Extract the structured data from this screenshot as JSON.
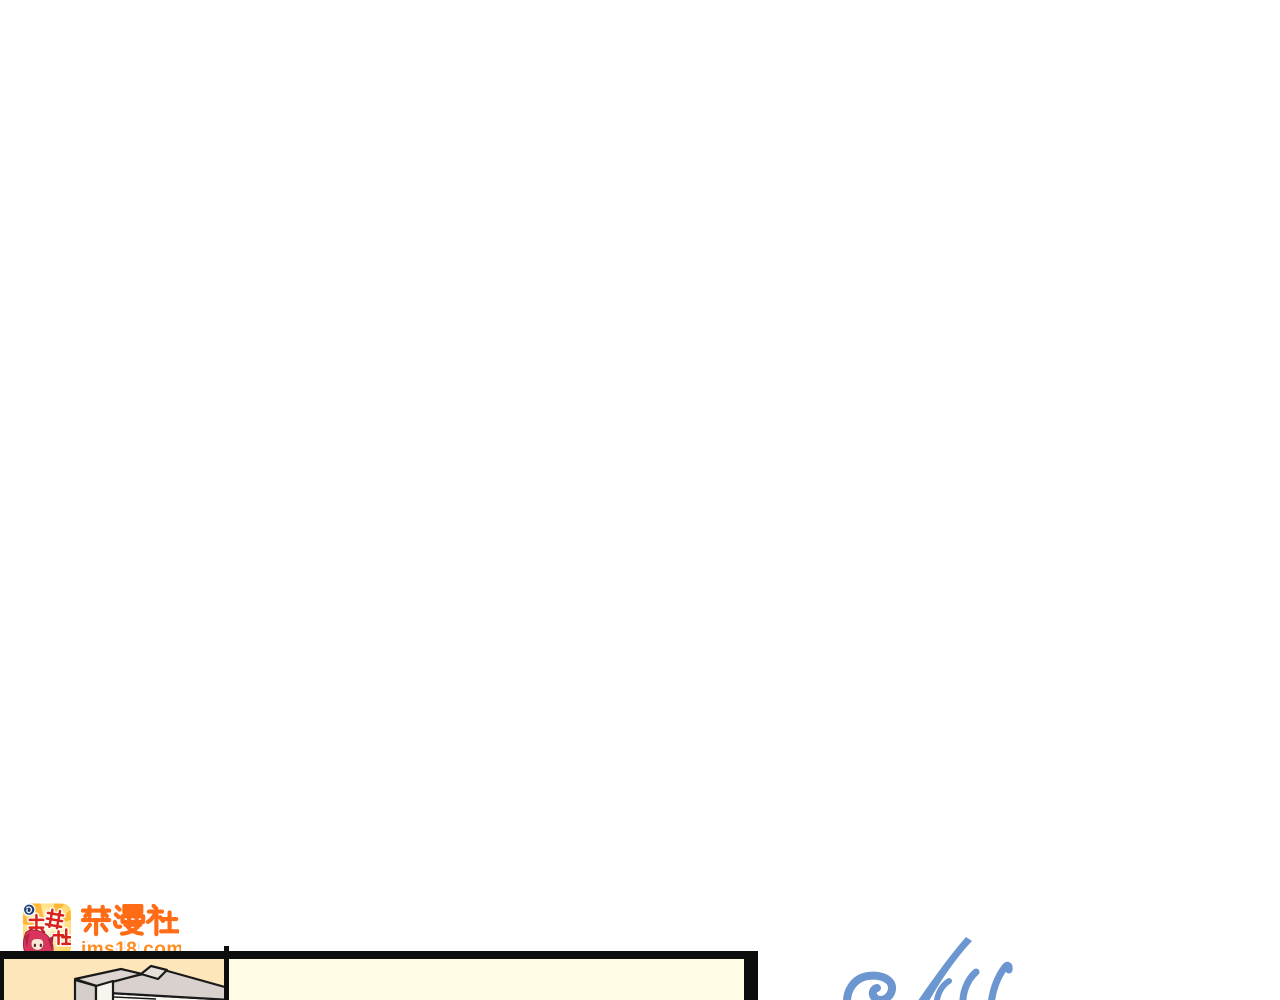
{
  "page": {
    "background_color": "#ffffff"
  },
  "watermark": {
    "icon": {
      "name": "jinmanshe-app-icon",
      "badge_char": "の",
      "kanji_text": "禁漫社",
      "burst_color": "#ffa517",
      "kanji_red": "#d8231b",
      "hair_color": "#d8345c"
    },
    "title_text": "禁漫社",
    "site_url": "jms18.com",
    "colors": {
      "title_orange": "#ff6c15",
      "url_orange": "#ff8c1f",
      "url_outline": "#ffffff"
    }
  },
  "comic_panel": {
    "border_color": "#0d0d0d",
    "left_panel_bg": "#fde7ba",
    "right_panel_bg": "#fffbe5",
    "furniture": {
      "top_gray": "#d9d1ce",
      "post_top_gray": "#ddd5d1",
      "post_front_gray": "#d6cecb",
      "front_white": "#faf6f0",
      "outline": "#1a1a1a"
    }
  },
  "signature_scribble": {
    "color": "#6c96d0"
  }
}
